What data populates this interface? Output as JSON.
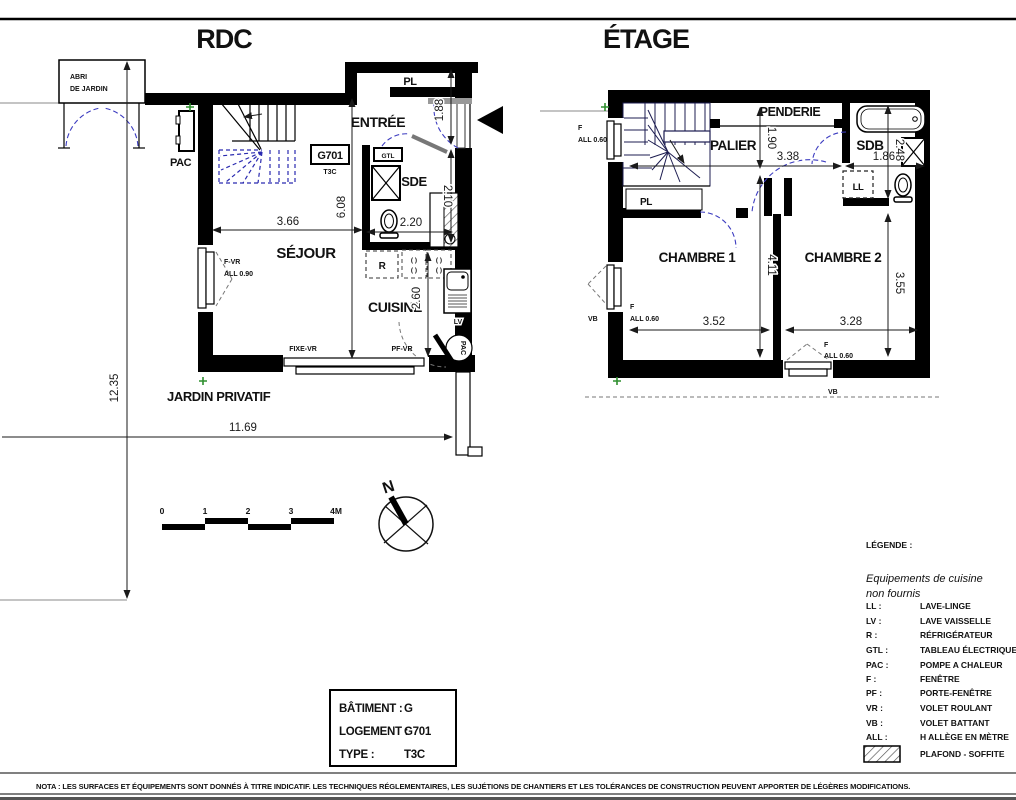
{
  "titles": {
    "rdc": "RDC",
    "etage": "ÉTAGE"
  },
  "rdc": {
    "rooms": {
      "entree": "ENTRÉE",
      "pl": "PL",
      "sde": "SDE",
      "sejour": "SÉJOUR",
      "cuisine": "CUISINE",
      "jardin": "JARDIN PRIVATIF"
    },
    "annex": {
      "abri_line1": "ABRI",
      "abri_line2": "DE JARDIN",
      "pac_unit": "PAC"
    },
    "unit_box": {
      "code": "G701",
      "type": "T3C"
    },
    "equipment": {
      "gtl": "GTL",
      "r": "R",
      "lv": "LV",
      "pac": "PAC",
      "burners": "( )"
    },
    "windows": {
      "f_vr": "F-VR",
      "all_090": "ALL 0.90",
      "fixe_vr": "FIXE-VR",
      "pf_vr": "PF-VR"
    },
    "dims": {
      "w_sejour": "3.66",
      "h_main": "6.08",
      "w_sde": "2.20",
      "h_closet": "2.10",
      "h_entree": "1.88",
      "h_cuisine": "2.60",
      "h_plot": "12.35",
      "w_plot": "11.69"
    }
  },
  "etage": {
    "rooms": {
      "palier": "PALIER",
      "penderie": "PENDERIE",
      "sdb": "SDB",
      "pl": "PL",
      "chambre1": "CHAMBRE 1",
      "chambre2": "CHAMBRE 2"
    },
    "equipment": {
      "ll": "LL"
    },
    "windows": {
      "f": "F",
      "all_060": "ALL 0.60",
      "vb": "VB"
    },
    "dims": {
      "h_palier": "1.90",
      "w_palier": "3.38",
      "h_sdb": "2.48",
      "w_sdb": "1.86",
      "h_ch": "4.11",
      "h_ch2": "3.55",
      "w_ch1": "3.52",
      "w_ch2": "3.28"
    }
  },
  "scalebar": {
    "ticks": [
      "0",
      "1",
      "2",
      "3",
      "4M"
    ]
  },
  "compass": {
    "label": "N"
  },
  "info_box": {
    "rows": [
      {
        "label": "BÂTIMENT :",
        "value": "G"
      },
      {
        "label": "LOGEMENT :",
        "value": "G701"
      },
      {
        "label": "TYPE :",
        "value": "T3C"
      }
    ]
  },
  "legend": {
    "title": "LÉGENDE :",
    "note_line1": "Equipements de cuisine",
    "note_line2": "non fournis",
    "entries": [
      {
        "abbr": "LL :",
        "label": "LAVE-LINGE"
      },
      {
        "abbr": "LV :",
        "label": "LAVE VAISSELLE"
      },
      {
        "abbr": "R :",
        "label": "RÉFRIGÉRATEUR"
      },
      {
        "abbr": "GTL :",
        "label": "TABLEAU ÉLECTRIQUE"
      },
      {
        "abbr": "PAC :",
        "label": "POMPE A CHALEUR"
      },
      {
        "abbr": "F :",
        "label": "FENÊTRE"
      },
      {
        "abbr": "PF :",
        "label": "PORTE-FENÊTRE"
      },
      {
        "abbr": "VR :",
        "label": "VOLET ROULANT"
      },
      {
        "abbr": "VB :",
        "label": "VOLET BATTANT"
      },
      {
        "abbr": "ALL :",
        "label": "H ALLÈGE EN MÈTRE"
      }
    ],
    "hatch_label": "PLAFOND - SOFFITE"
  },
  "nota": "NOTA : LES SURFACES ET ÉQUIPEMENTS SONT DONNÉS À TITRE INDICATIF. LES TECHNIQUES RÉGLEMENTAIRES, LES SUJÉTIONS DE CHANTIERS ET LES TOLÉRANCES DE CONSTRUCTION PEUVENT APPORTER DE LÉGÈRES MODIFICATIONS.",
  "colors": {
    "wall": "#000000",
    "stair_blue": "#2a2ab0",
    "door_swing": "#3c3cc0",
    "dimension": "#1a1a1a",
    "site_marker_green": "#2f8f2f",
    "boundary_gray": "#8a8a8a"
  }
}
